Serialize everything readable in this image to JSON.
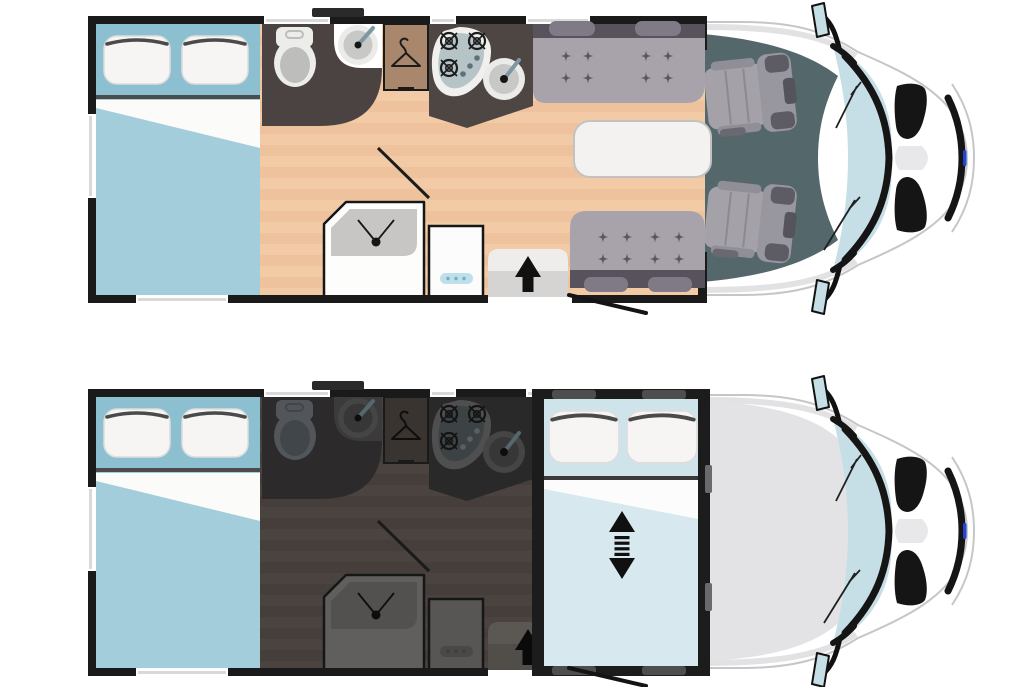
{
  "figure": {
    "type": "motorhome-floorplan-comparison",
    "views": [
      {
        "id": "day",
        "elements": [
          "rear-bed",
          "bathroom",
          "wardrobe",
          "kitchen",
          "shower",
          "fridge",
          "entry-step",
          "dinette-benches",
          "dinette-table",
          "cab-swivel-seats"
        ]
      },
      {
        "id": "night",
        "elements": [
          "rear-bed",
          "bathroom",
          "wardrobe",
          "kitchen",
          "shower",
          "fridge",
          "entry-step",
          "drop-down-bed",
          "cab-roof-closed"
        ]
      }
    ]
  },
  "icons": {
    "hanger-icon": "clothes-hanger outline",
    "stove-burner-icon": "circle with cross",
    "faucet-icon": "lever over basin dot",
    "shower-mixer-icon": "dot with two levers",
    "entry-arrow-icon": "solid up arrow",
    "bed-lift-arrow-icon": "vertical double arrow with dashed shaft",
    "fridge-control-icon": "pill with three dots",
    "wiper-icon": "thin angled lines on windshield"
  },
  "palette": {
    "shared": {
      "wall": "#1a1a1a",
      "body": "#ffffff",
      "body-edge": "#c6c6c9",
      "windshield": "#c6dee6",
      "bed-head": "#8cc0d1",
      "bed-duvet": "#a3cdda",
      "bed-fold": "#fbfbfa",
      "divider": "#4c4c4c",
      "roof": "#e3e3e5",
      "slate": "#54676b",
      "logo": "#2545cc",
      "sill": "#d9d9d9",
      "night-bed-head": "#cfe4ea",
      "night-bed-duvet": "#d7e9ef"
    },
    "day": {
      "floor": "#f2cba6",
      "floor-stripe": "#eec29d",
      "bath": "#4b4341",
      "sink-panel": "#ffffff",
      "fixture-light": "#ececea",
      "fixture-mid": "#bdbdbb",
      "faucet": "#7e98a2",
      "wardrobe": "#a9876c",
      "hanger": "#1c1c1c",
      "kitchen": "#4e4643",
      "stove-blob": "#f1f0ee",
      "stove-inner": "#b6c4c8",
      "burner": "#1d1d1d",
      "knob": "#5e7179",
      "sink-ring": "#ebebe9",
      "sink-bowl": "#c8c8c6",
      "mixer": "#151515",
      "shower-box": "#fdfdfc",
      "shower-tray": "#c7c6c4",
      "fridge": "#fcfcfc",
      "fridge-strip": "#bfe0ea",
      "fridge-dots": "#6fb0c6",
      "step": "#d5d4d2",
      "step-top": "#eeedeb",
      "arrow": "#111111",
      "bench": "#a8a2aa",
      "bench-strip": "#57525c",
      "bench-head": "#7f7a86",
      "spark": "#5b5662",
      "table": "#f3f2f0",
      "table-edge": "#c2c2c2"
    },
    "night": {
      "floor": "#4a433f",
      "floor-stripe": "#453e3a",
      "bath": "#2c2a2a",
      "sink-panel": "#3b3b3b",
      "fixture-light": "#52565a",
      "fixture-mid": "#41464a",
      "faucet": "#55686f",
      "wardrobe": "#39342f",
      "hanger": "#0e0e0e",
      "kitchen": "#2a2929",
      "stove-blob": "#4f4f4f",
      "stove-inner": "#3d4345",
      "burner": "#141414",
      "knob": "#566066",
      "sink-ring": "#454545",
      "sink-bowl": "#373737",
      "mixer": "#0d0d0d",
      "shower-box": "#615f5e",
      "shower-tray": "#535150",
      "fridge": "#585654",
      "fridge-strip": "#4b4947",
      "fridge-dots": "#403e3c",
      "step": "#514d49",
      "step-top": "#5b5753",
      "arrow": "#0a0a0a",
      "bench": "#a8a2aa",
      "bench-strip": "#57525c",
      "bench-head": "#7f7a86",
      "spark": "#5b5662",
      "table": "#f3f2f0",
      "table-edge": "#c2c2c2"
    }
  }
}
